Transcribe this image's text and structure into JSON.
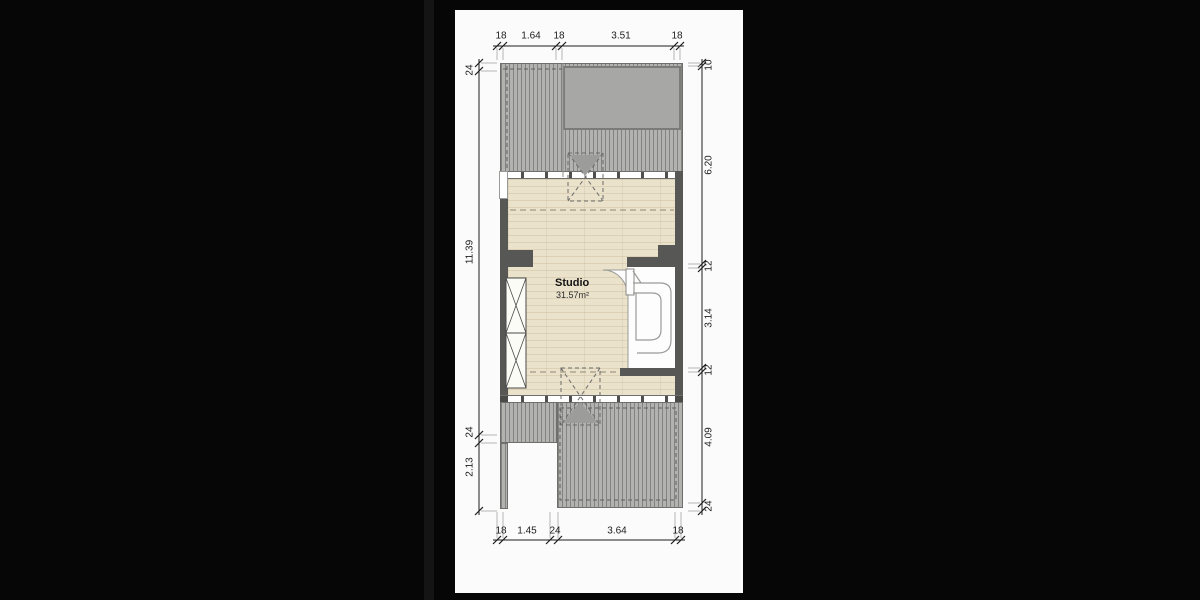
{
  "plan": {
    "room": {
      "name": "Studio",
      "area": "31.57m²"
    },
    "dims": {
      "top": [
        "18",
        "1.64",
        "18",
        "3.51",
        "18"
      ],
      "bottom": [
        "18",
        "1.45",
        "24",
        "3.64",
        "18"
      ],
      "left": [
        "24",
        "11.39",
        "24",
        "2.13"
      ],
      "right": [
        "10",
        "6.20",
        "12",
        "3.14",
        "12",
        "4.09",
        "24"
      ]
    },
    "colors": {
      "background": "#060606",
      "paper": "#fbfbfb",
      "wall": "#575755",
      "deck": "#b2b2b0",
      "roof_overhang": "#a7a7a5",
      "floor": "#ebe2cc",
      "dimension_text": "#1c1c1c",
      "symbol_gray": "#9c9c9a"
    }
  }
}
